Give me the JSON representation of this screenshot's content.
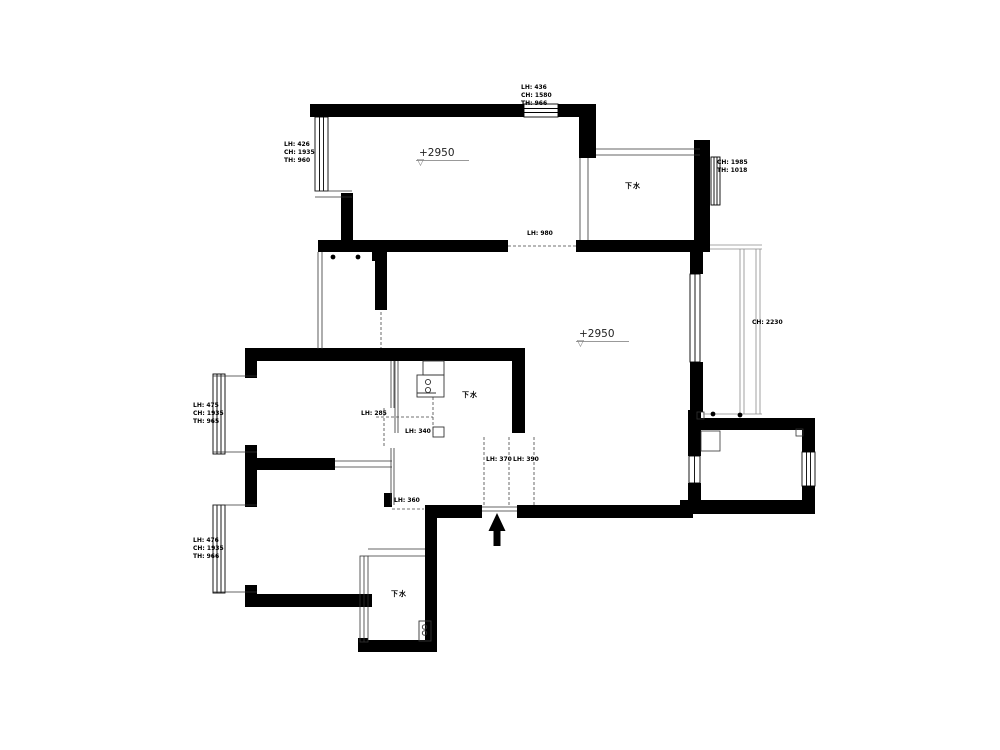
{
  "title": "apartment-floor-plan",
  "colors": {
    "wall": "#000000",
    "thin_line": "#333333",
    "light_line": "#8a8a8a",
    "background": "#ffffff"
  },
  "window_specs": [
    {
      "id": "top-center",
      "lines": [
        "LH: 436",
        "CH: 1580",
        "TH: 966"
      ]
    },
    {
      "id": "top-left",
      "lines": [
        "LH: 426",
        "CH: 1935",
        "TH: 960"
      ]
    },
    {
      "id": "top-right",
      "lines": [
        "CH: 1985",
        "TH: 1018"
      ]
    },
    {
      "id": "mid-left",
      "lines": [
        "LH: 475",
        "CH: 1935",
        "TH: 965"
      ]
    },
    {
      "id": "bottom-left",
      "lines": [
        "LH: 476",
        "CH: 1935",
        "TH: 966"
      ]
    }
  ],
  "level_markers": [
    "+2950",
    "+2950"
  ],
  "drain_labels": [
    "下水",
    "下水",
    "下水"
  ],
  "dims": {
    "opening_top": "LH: 980",
    "right_corridor": "CH: 2230",
    "door_a": "LH: 285",
    "door_b": "LH: 340",
    "door_c": "LH: 370",
    "door_d": "LH: 390",
    "door_e": "LH: 360"
  }
}
